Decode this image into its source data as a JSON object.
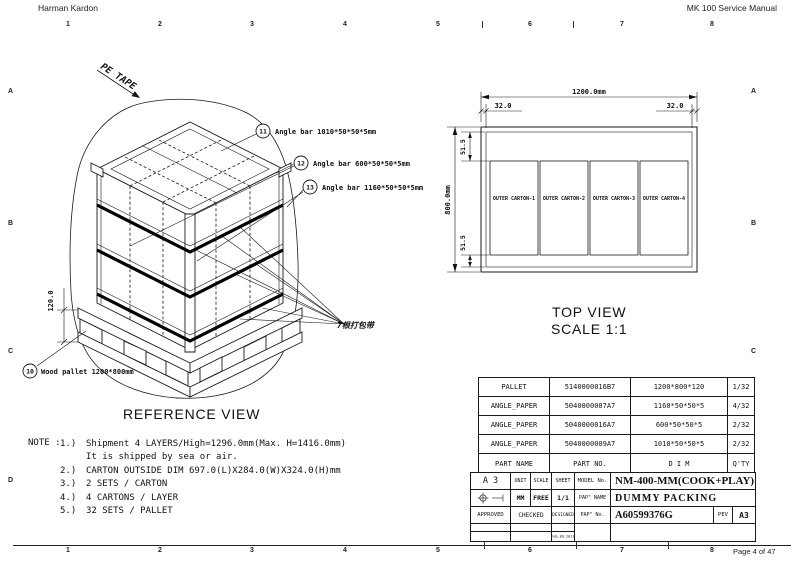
{
  "page": {
    "header_left": "Harman Kardon",
    "header_right": "MK 100 Service Manual",
    "footer": "Page 4 of 47",
    "ruler_numbers": [
      "1",
      "2",
      "3",
      "4",
      "5",
      "6",
      "7",
      "8"
    ],
    "zone_letters": [
      "A",
      "B",
      "C",
      "D"
    ]
  },
  "reference_view": {
    "title": "REFERENCE VIEW",
    "pe_tape": "PE TAPE",
    "strap_note": "7根打包带",
    "pallet_height_dim": "120.0",
    "callout_11": {
      "num": "11",
      "label": "Angle bar 1010*50*50*5mm"
    },
    "callout_12": {
      "num": "12",
      "label": "Angle bar 600*50*50*5mm"
    },
    "callout_13": {
      "num": "13",
      "label": "Angle bar 1160*50*50*5mm"
    },
    "callout_10": {
      "num": "10",
      "label": "Wood pallet 1200*800mm"
    }
  },
  "top_view": {
    "title": "TOP VIEW",
    "scale": "SCALE 1:1",
    "dims": {
      "width": "1200.0mm",
      "height": "800.0mm",
      "left": "32.0",
      "right": "32.0",
      "top": "51.5",
      "bottom": "51.5"
    },
    "cartons": [
      "OUTER CARTON-1",
      "OUTER CARTON-2",
      "OUTER CARTON-3",
      "OUTER CARTON-4"
    ]
  },
  "parts_table": {
    "rows": [
      {
        "name": "PALLET",
        "no": "5140000016B7",
        "dim": "1200*800*120",
        "qty": "1/32"
      },
      {
        "name": "ANGLE_PAPER",
        "no": "5040000007A7",
        "dim": "1160*50*50*5",
        "qty": "4/32"
      },
      {
        "name": "ANGLE_PAPER",
        "no": "5040000016A7",
        "dim": "600*50*50*5",
        "qty": "2/32"
      },
      {
        "name": "ANGLE_PAPER",
        "no": "5040000009A7",
        "dim": "1010*50*50*5",
        "qty": "2/32"
      }
    ],
    "header": {
      "name": "PART NAME",
      "no": "PART NO.",
      "dim": "D I M",
      "qty": "Q'TY"
    }
  },
  "title_block": {
    "size": "A 3",
    "unit_label": "UNIT",
    "scale_label": "SCALE",
    "sheet_label": "SHEET",
    "model_label": "MODEL No.",
    "model": "NM-400-MM(COOK+PLAY)",
    "unit": "MM",
    "scale": "FREE",
    "sheet": "1/1",
    "pap_name_label": "PAP\" NAME",
    "pap_name": "DUMMY PACKING",
    "approved_label": "APPROVED",
    "checked_label": "CHECKED",
    "designed_label": "DESIGNED",
    "pap_no_label": "PAP\" No.",
    "pap_no": "A60599376G",
    "rev_label": "PEV",
    "rev": "A3",
    "date": "Feb.09.2011"
  },
  "notes": {
    "label": "NOTE :",
    "items": [
      {
        "num": "1.)",
        "text": "Shipment 4 LAYERS/High=1296.0mm(Max. H=1416.0mm)"
      },
      {
        "num": "",
        "text": "It is shipped by sea or air."
      },
      {
        "num": "2.)",
        "text": "CARTON OUTSIDE DIM 697.0(L)X284.0(W)X324.0(H)mm"
      },
      {
        "num": "3.)",
        "text": "2 SETS / CARTON"
      },
      {
        "num": "4.)",
        "text": "4 CARTONS / LAYER"
      },
      {
        "num": "5.)",
        "text": "32 SETS / PALLET"
      }
    ]
  }
}
